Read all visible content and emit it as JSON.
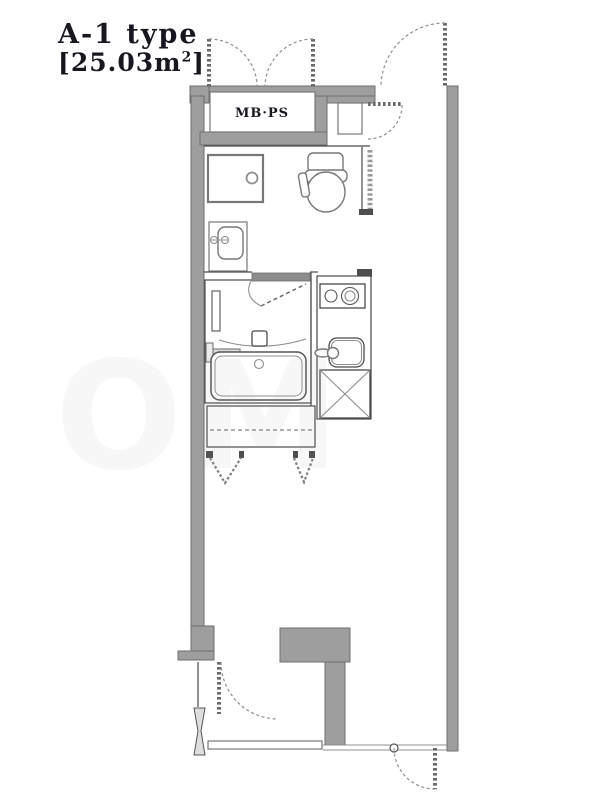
{
  "plan": {
    "unit_type": "A-1 type",
    "area": {
      "open_bracket": "[",
      "value": "25.03",
      "unit": "m",
      "superscript": "2",
      "close_bracket": "]"
    },
    "labels": {
      "meter_box": "MB·PS"
    },
    "watermark": "OM",
    "colors": {
      "background": "#ffffff",
      "wall_fill": "#9e9e9e",
      "wall_edge": "#6e6e6e",
      "line_dark": "#4a4a4a",
      "line_mid": "#6a6a6a",
      "line_light": "#8f8f8f",
      "fixture_line": "#777777",
      "title_text": "#17171f",
      "watermark_color": "#9a9a9a"
    },
    "fixtures": [
      "meter-box-double-doors",
      "entrance-door",
      "shoe-cabinet",
      "washing-machine-pan",
      "toilet",
      "washbasin",
      "toilet-room-door",
      "bathroom-door",
      "mirror-cabinet",
      "shower-bar",
      "mixing-valve",
      "bathtub",
      "two-burner-stove",
      "kitchen-sink",
      "refrigerator-space",
      "closet-bifold-doors",
      "balcony-door",
      "service-door",
      "balcony-partition",
      "sliding-window"
    ]
  }
}
